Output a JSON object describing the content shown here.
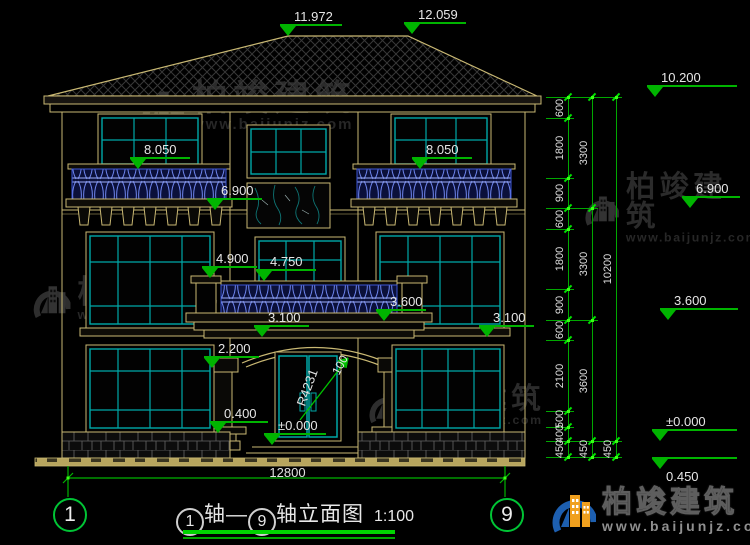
{
  "colors": {
    "line_tan": "#c9b873",
    "dim_green": "#00b400",
    "bright_green": "#00d400",
    "window_cyan": "#00a8a8",
    "railing_blue": "#5f79e8",
    "text_light": "#e6e6e6",
    "watermark_gray": "#2b2b2b",
    "logo_blue": "#1d5fb0",
    "logo_orange": "#f0a01e"
  },
  "markers": [
    {
      "label": "11.972",
      "x": 288,
      "y": 36,
      "w": 62
    },
    {
      "label": "12.059",
      "x": 412,
      "y": 34,
      "w": 62
    },
    {
      "label": "10.200",
      "x": 655,
      "y": 97,
      "w": 90
    },
    {
      "label": "8.050",
      "x": 138,
      "y": 169,
      "w": 60
    },
    {
      "label": "8.050",
      "x": 420,
      "y": 169,
      "w": 60
    },
    {
      "label": "6.900",
      "x": 215,
      "y": 210,
      "w": 55
    },
    {
      "label": "6.900",
      "x": 690,
      "y": 208,
      "w": 58
    },
    {
      "label": "4.900",
      "x": 210,
      "y": 278,
      "w": 55
    },
    {
      "label": "4.750",
      "x": 264,
      "y": 281,
      "w": 60
    },
    {
      "label": "3.600",
      "x": 384,
      "y": 321,
      "w": 50
    },
    {
      "label": "3.600",
      "x": 668,
      "y": 320,
      "w": 78
    },
    {
      "label": "3.100",
      "x": 262,
      "y": 337,
      "w": 55
    },
    {
      "label": "3.100",
      "x": 487,
      "y": 337,
      "w": 55
    },
    {
      "label": "2.200",
      "x": 212,
      "y": 368,
      "w": 55
    },
    {
      "label": "0.400",
      "x": 218,
      "y": 433,
      "w": 58
    },
    {
      "label": "±0.000",
      "x": 272,
      "y": 445,
      "w": 62
    },
    {
      "label": "±0.000",
      "x": 660,
      "y": 441,
      "w": 85
    },
    {
      "label": "0.450",
      "x": 660,
      "y": 457,
      "w": 85,
      "type": "below"
    }
  ],
  "annotations": {
    "radius_label": "R4231",
    "arch_offset_label": "100"
  },
  "right_chain": {
    "columns": [
      {
        "x": 568,
        "segments": [
          {
            "y1": 97,
            "y2": 118,
            "label": "600"
          },
          {
            "y1": 118,
            "y2": 178,
            "label": "1800"
          },
          {
            "y1": 178,
            "y2": 208,
            "label": "900"
          },
          {
            "y1": 208,
            "y2": 229,
            "label": "600"
          },
          {
            "y1": 229,
            "y2": 289,
            "label": "1800"
          },
          {
            "y1": 289,
            "y2": 320,
            "label": "900"
          },
          {
            "y1": 320,
            "y2": 340,
            "label": "600"
          },
          {
            "y1": 340,
            "y2": 411,
            "label": "2100"
          },
          {
            "y1": 411,
            "y2": 427,
            "label": "500"
          },
          {
            "y1": 427,
            "y2": 441,
            "label": "400"
          },
          {
            "y1": 441,
            "y2": 457,
            "label": "450"
          }
        ]
      },
      {
        "x": 592,
        "segments": [
          {
            "y1": 97,
            "y2": 208,
            "label": "3300"
          },
          {
            "y1": 208,
            "y2": 320,
            "label": "3300"
          },
          {
            "y1": 320,
            "y2": 441,
            "label": "3600"
          },
          {
            "y1": 441,
            "y2": 457,
            "label": "450"
          }
        ]
      },
      {
        "x": 616,
        "segments": [
          {
            "y1": 97,
            "y2": 441,
            "label": "10200"
          },
          {
            "y1": 441,
            "y2": 457,
            "label": "450"
          }
        ]
      }
    ]
  },
  "bottom_dim": {
    "label": "12800"
  },
  "axes": {
    "left": "1",
    "right": "9"
  },
  "title": {
    "mid": "轴—",
    "suffix": "轴立面图",
    "scale": "1:100"
  },
  "watermark": {
    "brand": "柏竣建筑",
    "url": "www.baijunjz.com",
    "spots": [
      {
        "x": 138,
        "y": 80,
        "s": 1.0
      },
      {
        "x": 582,
        "y": 172,
        "s": 0.82
      },
      {
        "x": 30,
        "y": 276,
        "s": 0.88
      },
      {
        "x": 366,
        "y": 384,
        "s": 0.82
      }
    ]
  },
  "footer_logo": {
    "brand": "柏竣建筑",
    "url": "www.baijunjz.com"
  }
}
